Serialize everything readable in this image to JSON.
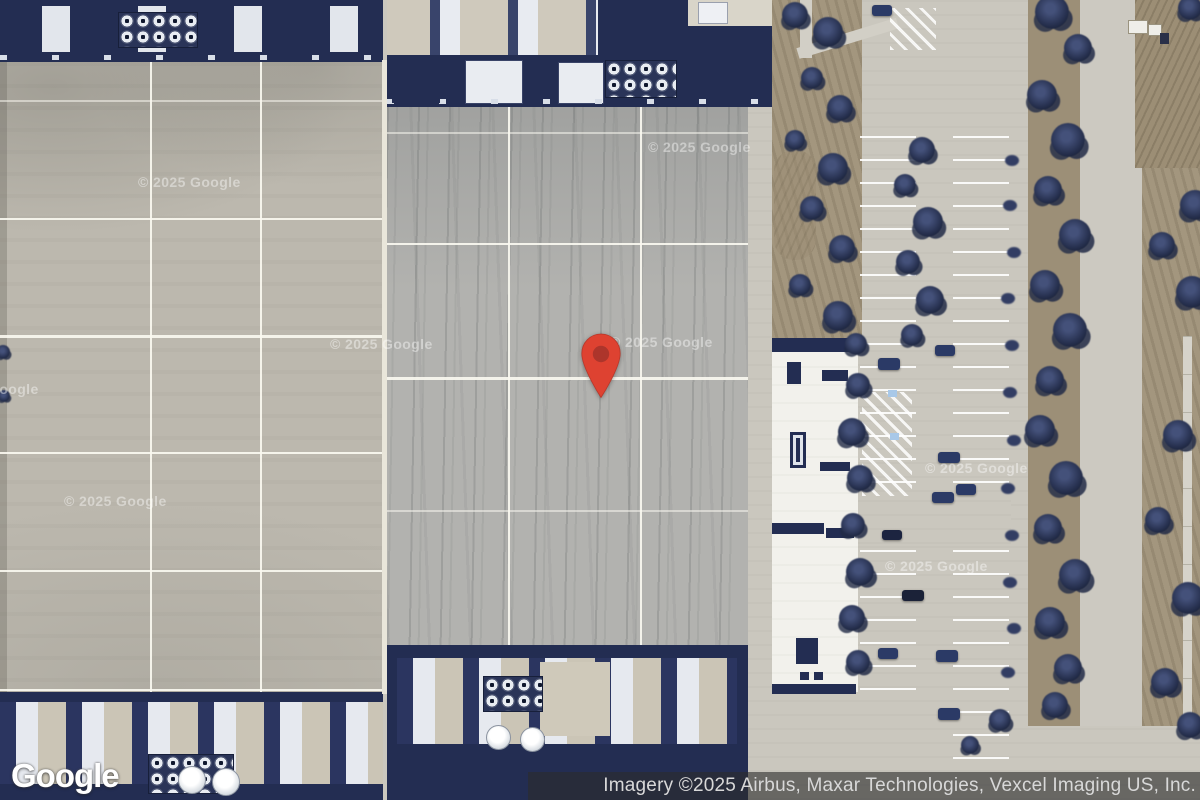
{
  "map": {
    "description": "Satellite aerial view of large industrial data center rooftops with cooling equipment, a parking lot with trees, and a red location marker",
    "logo": "Google",
    "attribution": "Imagery ©2025 Airbus, Maxar Technologies, Vexcel Imaging US, Inc.",
    "watermark": "© 2025 Google",
    "marker": {
      "name": "location-pin",
      "outer_color": "#de4231",
      "inner_color": "#ad352b"
    },
    "colors": {
      "roof_left": "#bcb8ae",
      "roof_middle": "#b2b2af",
      "equipment_navy": "#232d52",
      "equipment_unit_white": "#e6e9ef",
      "concrete": "#cac7be",
      "white_roof": "#f2f1ec",
      "grass": "#a3967e",
      "tree": "#2a3454",
      "attribution_bg": "rgba(43,43,43,0.62)",
      "attribution_text": "#d8d8d8"
    }
  }
}
